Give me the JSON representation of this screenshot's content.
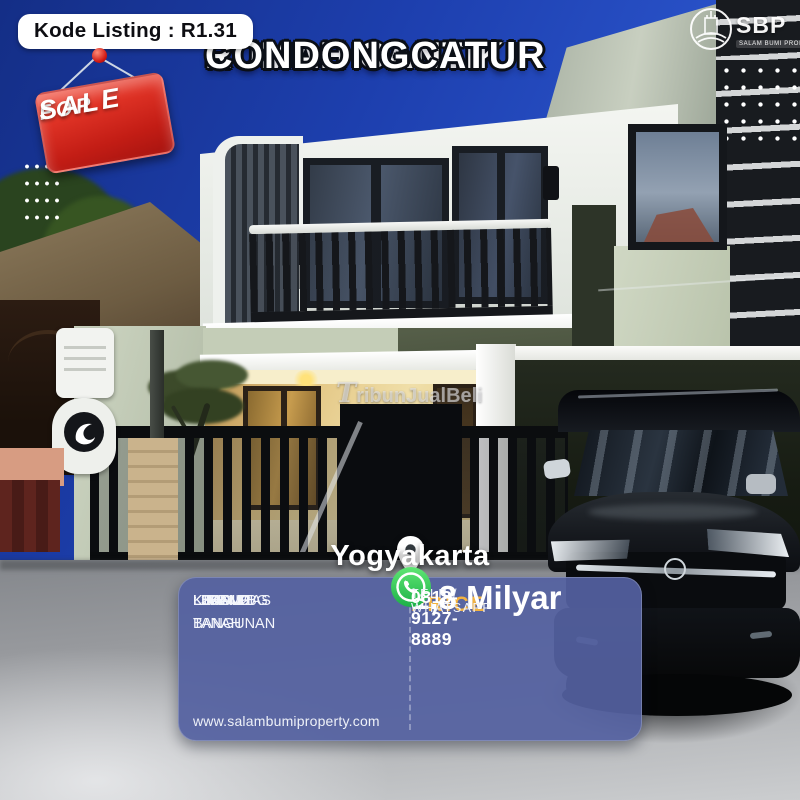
{
  "header": {
    "kode_listing": "Kode Listing : R1.31",
    "sale_tag_line1": "FOR",
    "sale_tag_line2": "SALE",
    "title_line1": "RUMAH CANTIK",
    "title_line2": "CONDONGCATUR",
    "logo_text": "SBP",
    "logo_subtext": "SALAM BUMI PROPERTY"
  },
  "photo": {
    "watermark": "TribunJualBeli",
    "location": "Yogyakarta"
  },
  "details": {
    "rows": [
      {
        "label": "LUAS TANAH",
        "value": ": 138 M2"
      },
      {
        "label": "LUAS BANGUNAN",
        "value": ": 188 M2"
      },
      {
        "label": "K.TIDUR",
        "value": ": 3"
      },
      {
        "label": "K.MANDI",
        "value": ": 2"
      },
      {
        "label": "LEGALITAS",
        "value": ": SHM PBG"
      }
    ],
    "website": "www.salambumiproperty.com"
  },
  "price": {
    "label": "PRICE",
    "value": "1,8 Milyar",
    "contact_label": "TELP / WHATSAPP",
    "phone": "0813-9127-8889"
  },
  "colors": {
    "panel_indigo": "#54619f",
    "price_yellow": "#f3b23f",
    "sale_red": "#d42920",
    "whatsapp_green": "#25d366",
    "sky_blue": "#1d3fae"
  }
}
